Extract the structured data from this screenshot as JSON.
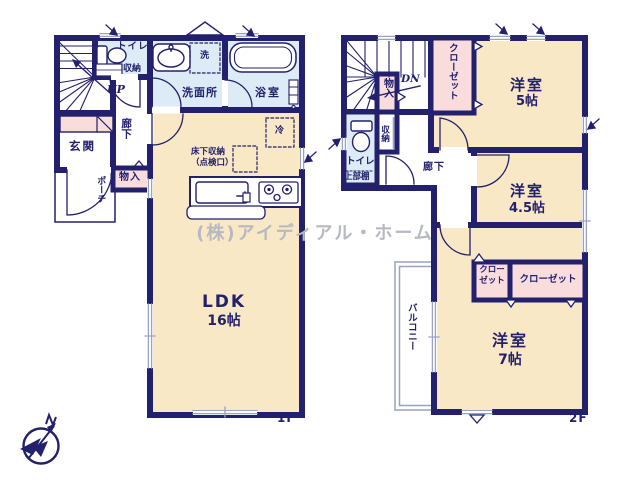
{
  "watermark": "(株)アイディアル・ホーム",
  "compass": {
    "direction": "N"
  },
  "colors": {
    "wall_navy": "#23206d",
    "room_beige": "#f8e8c6",
    "wet_blue": "#dcebf6",
    "closet_pink": "#f9dddd",
    "window_gray": "#9aa2c2",
    "watermark_gray": "#b7b9c2"
  },
  "floor1": {
    "floor_label": "1F",
    "rooms": {
      "ldk": {
        "name": "LDK",
        "size": "16帖"
      },
      "entrance": {
        "name": "玄関"
      },
      "porch": {
        "name": "ポーチ"
      },
      "hallway": {
        "name": "廊下"
      },
      "toilet": {
        "name": "トイレ"
      },
      "storage": {
        "name": "収納"
      },
      "closet": {
        "name": "物入"
      },
      "washroom": {
        "name": "洗面所"
      },
      "bathroom": {
        "name": "浴室"
      },
      "stairs": {
        "direction_label": "UP"
      }
    },
    "fixtures": {
      "washer": "洗",
      "fridge": "冷",
      "underfloor_storage": "床下収納\n（点検口）"
    }
  },
  "floor2": {
    "floor_label": "2F",
    "rooms": {
      "room5": {
        "name": "洋室",
        "size": "5帖",
        "closet": "クローゼット"
      },
      "room45": {
        "name": "洋室",
        "size": "4.5帖",
        "closet": "クロー\nゼット"
      },
      "room7": {
        "name": "洋室",
        "size": "7帖",
        "closet": "クローゼット"
      },
      "toilet": {
        "name": "トイレ",
        "shelf": "上部棚"
      },
      "storage": {
        "name": "収納"
      },
      "closet_hall": {
        "name": "物入"
      },
      "hallway": {
        "name": "廊下"
      },
      "balcony": {
        "name": "バルコニー"
      },
      "stairs": {
        "direction_label": "DN"
      }
    }
  }
}
